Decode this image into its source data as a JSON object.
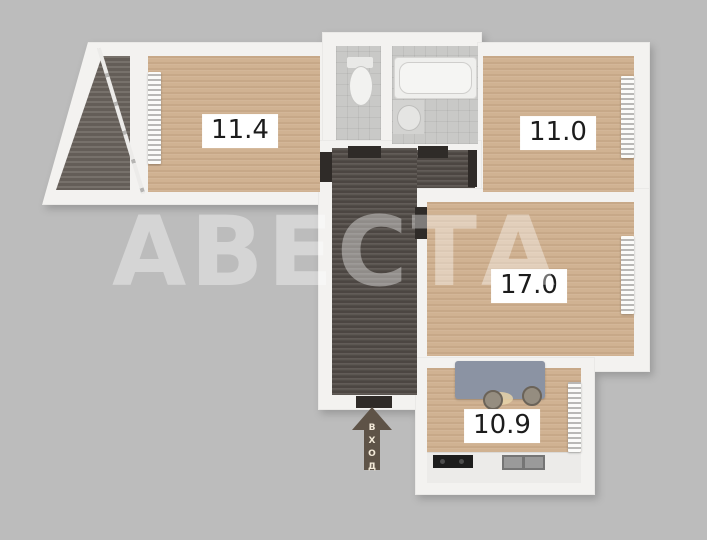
{
  "plan": {
    "watermark": "АВЕСТА",
    "entrance_label": "ВХОД",
    "rooms": [
      {
        "name": "room-top-left",
        "area_label": "11.4"
      },
      {
        "name": "room-top-right",
        "area_label": "11.0"
      },
      {
        "name": "room-middle-right",
        "area_label": "17.0"
      },
      {
        "name": "kitchen",
        "area_label": "10.9"
      }
    ]
  },
  "colors": {
    "background": "#bcbcbc",
    "wall": "#f3f2f0",
    "wood_floor": "#d0b292",
    "hallway_floor": "#56504b",
    "balcony_floor": "#6f6862",
    "tile_floor": "#c9c9c7",
    "door_dark": "#2f2b28",
    "entrance_arrow": "#5e5347",
    "kitchen_table": "#8b93a3",
    "label_text": "#1c1c1c",
    "watermark_text": "rgba(255,255,255,0.38)"
  }
}
